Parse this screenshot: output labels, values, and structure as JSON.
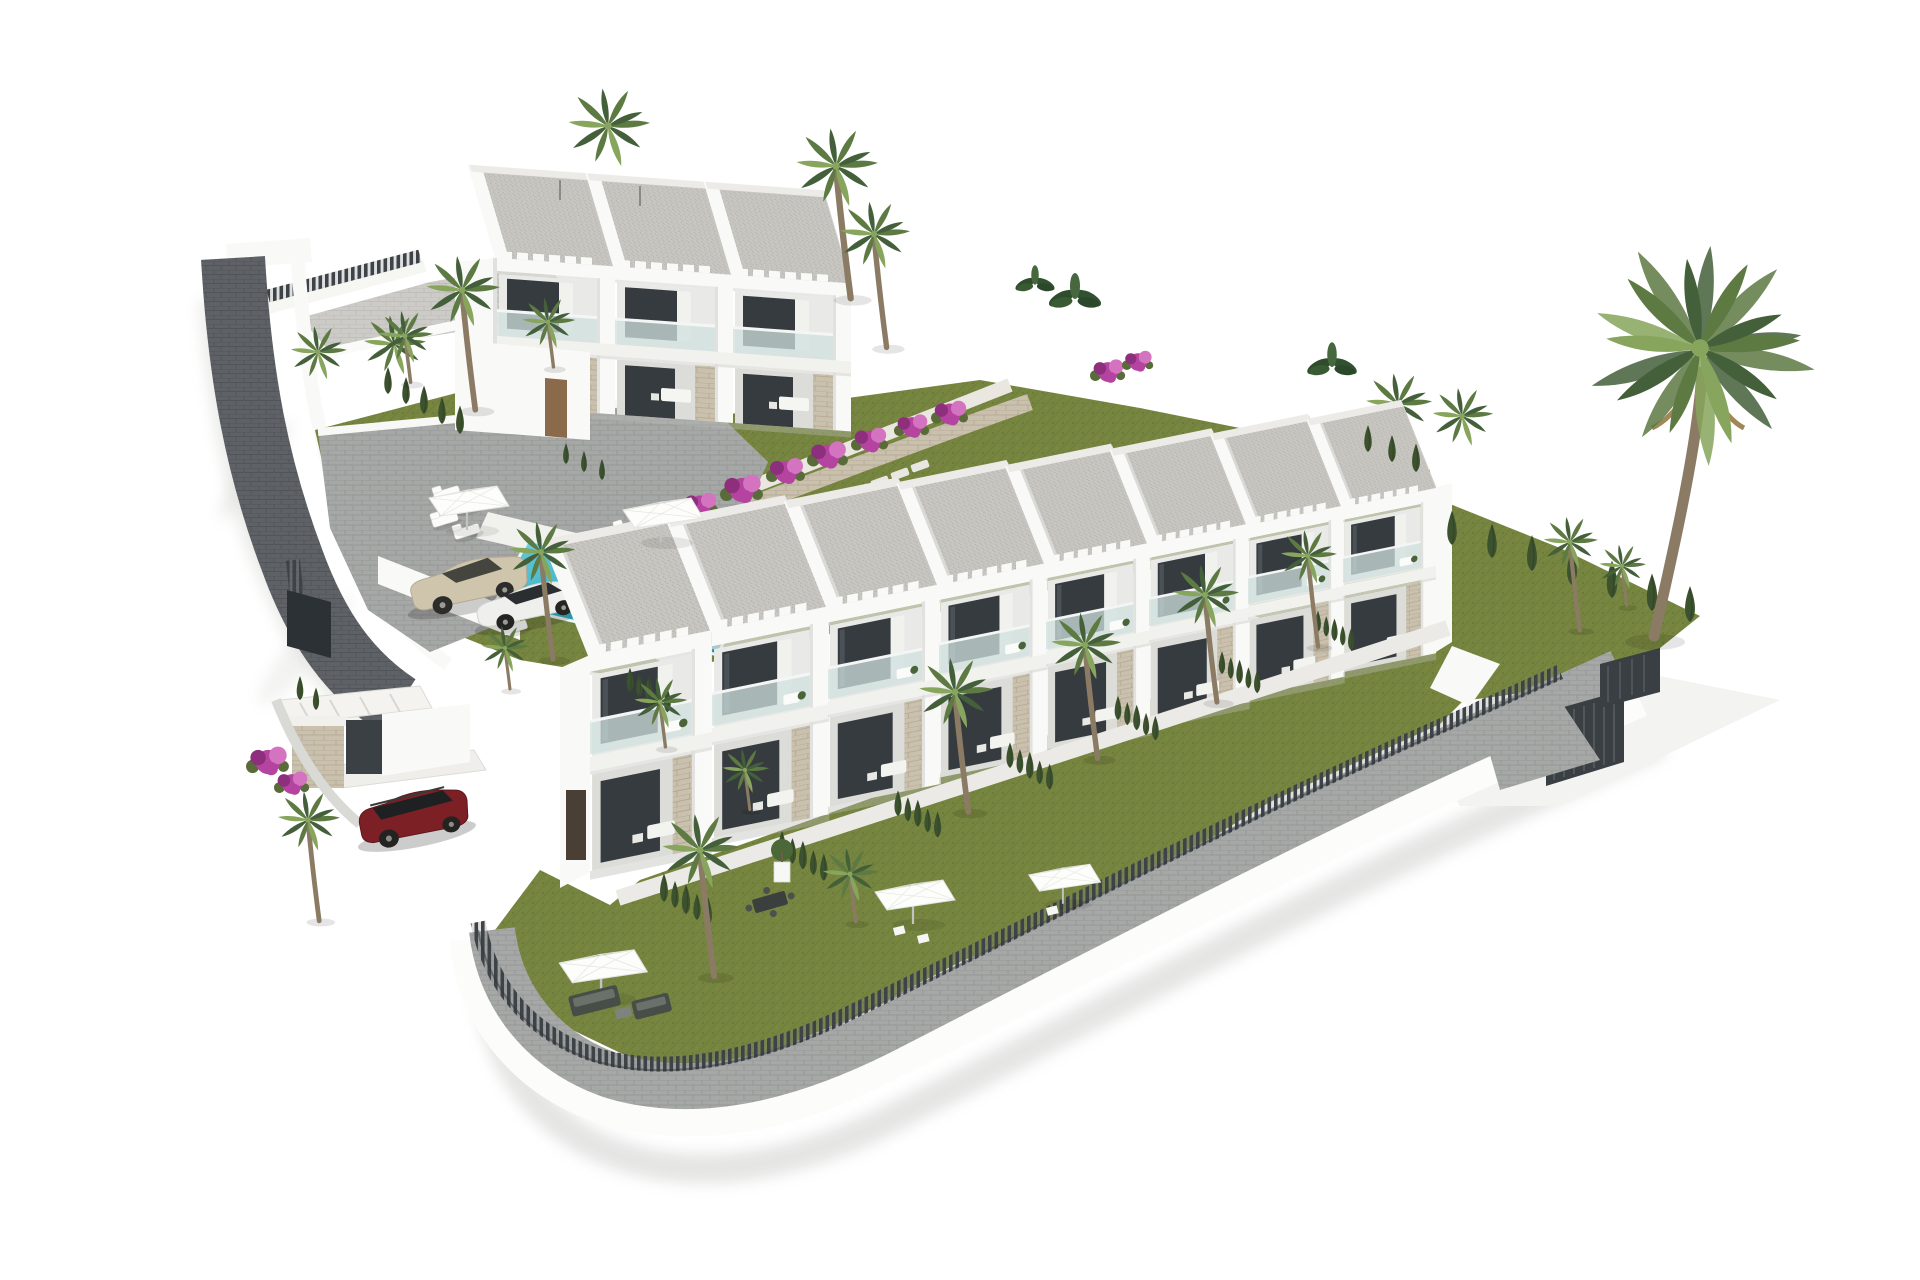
{
  "scene": {
    "description": "Aerial 3D architectural render of a white modern townhouse development on a hillside plot: an L-shaped layout with a rear 3-unit block, a long 8-unit front row with gravel flat roofs, glass balconies and pergolas, a turquoise pool with sun loungers and parasols, paver roads and parking, dark slatted perimeter fences, lawns, bougainvillea and many palm trees",
    "counts": {
      "buildings": 2,
      "front_row_units": 8,
      "rear_block_units": 3,
      "pools": 1,
      "cars": 3,
      "parasols": 5,
      "sun_loungers": 10,
      "gates": 2
    }
  },
  "colors": {
    "background": "#ffffff",
    "apron": "#f3f3f1",
    "wall_white": "#f9f9f7",
    "wall_shade": "#dddddad9",
    "slab": "#f1f1ee",
    "window_dark": "#363b3f",
    "glass": "#cfe0dd",
    "roof_gravel": "#c8c6c1",
    "stone": "#c9c0ae",
    "lawn": "#76853f",
    "pool_light": "#5ecfe0",
    "pool_dark": "#1d93aa",
    "palm_green": "#5d7a43",
    "palm_dark": "#44603a",
    "palm_light": "#87a55c",
    "cypress": "#3c512e",
    "trunk": "#8b7b64",
    "fence_dark": "#3e4347",
    "bougainvillea": "#b544a0",
    "bougainvillea_light": "#d473c0",
    "car_champagne": "#cfc5ad",
    "car_white": "#eff0ee",
    "car_red": "#7c2025",
    "shadow": "#d8d8d4"
  },
  "instances": {
    "steps": {
      "symbol": "sym-step",
      "item": "stepping-stone",
      "items": [
        [
          648,
          516
        ],
        [
          666,
          507
        ],
        [
          684,
          498
        ],
        [
          702,
          489
        ],
        [
          720,
          480
        ],
        [
          738,
          471
        ],
        [
          840,
          498
        ],
        [
          860,
          490
        ],
        [
          880,
          482
        ],
        [
          900,
          474
        ],
        [
          920,
          466
        ]
      ]
    },
    "loungers": {
      "symbol": "sym-lounger",
      "item": "sun-lounger",
      "items": [
        [
          447,
          494,
          1,
          -17
        ],
        [
          469,
          506,
          1,
          -17
        ],
        [
          445,
          520,
          1,
          -17
        ],
        [
          467,
          532,
          1,
          -17
        ],
        [
          628,
          528,
          1,
          -17
        ],
        [
          650,
          540,
          1,
          -17
        ],
        [
          672,
          552,
          1,
          -17
        ],
        [
          648,
          563,
          1,
          -17
        ],
        [
          495,
          616,
          0.95,
          -17
        ],
        [
          515,
          628,
          0.95,
          -17
        ]
      ]
    },
    "palms_behind": {
      "symbol": "sym-palm",
      "item": "palm-tree-canopy",
      "items": [
        [
          608,
          126,
          1.05
        ],
        [
          1398,
          404,
          0.85
        ],
        [
          1462,
          416,
          0.78
        ],
        [
          394,
          344,
          0.8
        ],
        [
          318,
          352,
          0.72
        ]
      ]
    },
    "bougainvillea": {
      "symbol": "sym-boug",
      "item": "bougainvillea-shrub",
      "items": [
        [
          618,
          538,
          1
        ],
        [
          658,
          522,
          1.05
        ],
        [
          700,
          506,
          0.95
        ],
        [
          742,
          490,
          1.1
        ],
        [
          786,
          472,
          1
        ],
        [
          828,
          456,
          1.05
        ],
        [
          870,
          441,
          0.95
        ],
        [
          912,
          427,
          0.9
        ],
        [
          950,
          414,
          0.95
        ],
        [
          1108,
          372,
          0.9
        ],
        [
          1138,
          362,
          0.8
        ],
        [
          268,
          762,
          1.1
        ],
        [
          292,
          784,
          0.9
        ]
      ]
    },
    "bushes": {
      "symbol": "sym-bush",
      "item": "tropical-bush",
      "items": [
        [
          1075,
          298,
          1
        ],
        [
          1332,
          366,
          0.95
        ],
        [
          1035,
          284,
          0.75
        ]
      ]
    },
    "units_a": {
      "symbol": "sym-unit-a",
      "item": "rear-block-townhouse-unit",
      "items": [
        [
          497,
          258,
          1
        ],
        [
          615,
          266.5,
          1
        ],
        [
          733,
          275,
          1
        ]
      ]
    },
    "units_b": {
      "symbol": "sym-unit-b",
      "item": "front-row-townhouse-unit",
      "items": [
        [
          590,
          655,
          1.06
        ],
        [
          712,
          630,
          1.02
        ],
        [
          828,
          607,
          0.98
        ],
        [
          939,
          585,
          0.945
        ],
        [
          1046,
          564,
          0.91
        ],
        [
          1149,
          544,
          0.875
        ],
        [
          1248,
          525,
          0.84
        ],
        [
          1343,
          507,
          0.81
        ]
      ]
    },
    "hedgerows": {
      "symbol": "sym-hedgerow",
      "item": "cypress-hedge-row",
      "items": [
        [
          664,
          902,
          1
        ],
        [
          782,
          858,
          0.95
        ],
        [
          898,
          816,
          0.9
        ],
        [
          1010,
          768,
          0.9
        ],
        [
          1118,
          720,
          0.85
        ],
        [
          1222,
          674,
          0.8
        ],
        [
          1318,
          632,
          0.75
        ],
        [
          630,
          692,
          0.85
        ]
      ]
    },
    "cypress_single": {
      "symbol": "sym-cypress",
      "item": "cypress-tree",
      "items": [
        [
          388,
          394,
          0.9
        ],
        [
          406,
          404,
          0.9
        ],
        [
          424,
          414,
          0.95
        ],
        [
          442,
          424,
          0.9
        ],
        [
          460,
          434,
          0.95
        ],
        [
          566,
          464,
          0.7
        ],
        [
          584,
          472,
          0.7
        ],
        [
          602,
          480,
          0.7
        ],
        [
          1452,
          545,
          1.15
        ],
        [
          1492,
          558,
          1.15
        ],
        [
          1532,
          571,
          1.2
        ],
        [
          1572,
          585,
          1.2
        ],
        [
          1612,
          598,
          1.25
        ],
        [
          1652,
          611,
          1.25
        ],
        [
          1690,
          622,
          1.2
        ],
        [
          1368,
          452,
          0.9
        ],
        [
          1392,
          462,
          0.9
        ],
        [
          1416,
          472,
          0.95
        ],
        [
          300,
          700,
          0.8
        ],
        [
          316,
          710,
          0.75
        ]
      ]
    },
    "palms_tall": {
      "symbol": "sym-palm-tall",
      "item": "palm-tree",
      "items": [
        [
          548,
          322,
          0.68
        ],
        [
          850,
          874,
          0.72
        ],
        [
          660,
          702,
          0.68
        ],
        [
          1622,
          566,
          0.6
        ],
        [
          505,
          648,
          0.62
        ],
        [
          405,
          336,
          0.7
        ],
        [
          745,
          770,
          0.6
        ]
      ]
    },
    "palms_xtall": {
      "symbol": "sym-palm-xtall",
      "item": "palm-tree",
      "items": [
        [
          836,
          166,
          1.05
        ],
        [
          874,
          234,
          0.9
        ],
        [
          462,
          290,
          0.95
        ],
        [
          541,
          552,
          0.85
        ],
        [
          700,
          850,
          1
        ],
        [
          955,
          692,
          0.95
        ],
        [
          1085,
          645,
          0.9
        ],
        [
          1205,
          595,
          0.85
        ],
        [
          1308,
          556,
          0.72
        ],
        [
          308,
          820,
          0.8
        ],
        [
          1570,
          542,
          0.7
        ]
      ]
    },
    "umbrellas": {
      "symbol": "sym-umbrella",
      "item": "parasol",
      "items": [
        [
          466,
          528,
          1
        ],
        [
          660,
          540,
          1
        ],
        [
          600,
          996,
          1.1
        ],
        [
          912,
          922,
          1
        ],
        [
          1062,
          902,
          0.9
        ]
      ]
    }
  }
}
